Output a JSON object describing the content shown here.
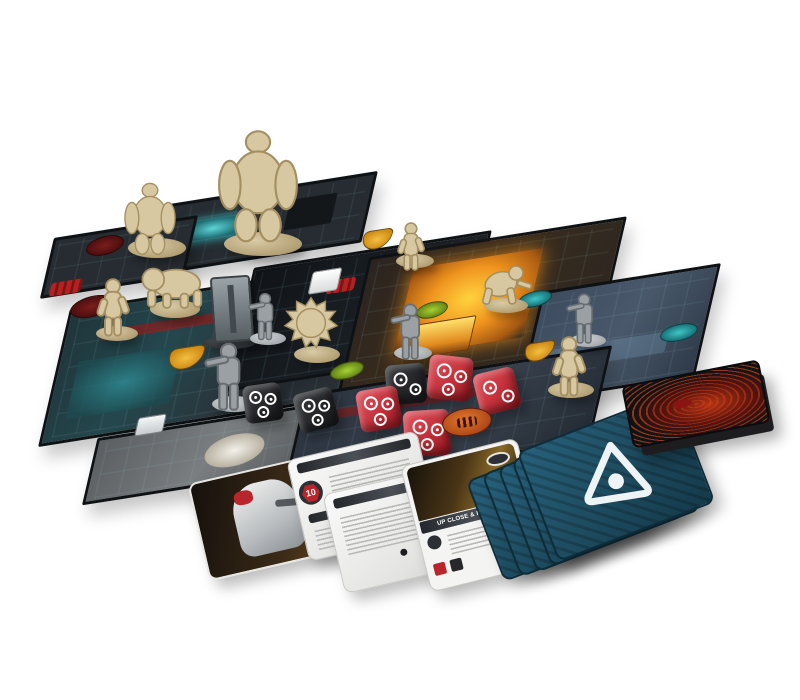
{
  "scene": {
    "description": "Sci-fi horror dungeon-crawler board game (DOOM-style) set up and photographed on a white background",
    "background": "#ffffff"
  },
  "board": {
    "tile_count": 8,
    "tile_colors": {
      "dark": "#262c31",
      "teal_glow": "#2f7d84",
      "lava_orange": "#f0941e",
      "blue_grey": "#49596b"
    },
    "tokens": [
      {
        "name": "portal-token",
        "color": "#5f1717",
        "count": 2
      },
      {
        "name": "rune-marker",
        "color": "#a32020",
        "count": 2
      },
      {
        "name": "shield-token",
        "color": "#e0a11e",
        "count": 3
      },
      {
        "name": "status-token-green",
        "color": "#7da821",
        "count": 2
      },
      {
        "name": "status-token-teal",
        "color": "#1d8f94",
        "count": 2
      },
      {
        "name": "terminal-token",
        "color": "#e8ecee",
        "count": 1
      },
      {
        "name": "objective-marker",
        "color": "#f2f2f0",
        "count": 1
      }
    ],
    "miniatures": {
      "demon_color": "#d8c8a2",
      "marine_color": "#9aa0a4",
      "demons": [
        "baron",
        "mancubus",
        "pinky",
        "cacodemon",
        "imp",
        "imp",
        "zombie",
        "zombie"
      ],
      "marine_count": 4,
      "door_count": 1
    }
  },
  "dice": {
    "black": {
      "count": 3,
      "color": "#26282b",
      "pip_style": "gear-ring",
      "pip_color": "#ffffff"
    },
    "red": {
      "count": 4,
      "color": "#c4313a",
      "pip_style": "ring",
      "pip_color": "#ffffff"
    },
    "threat_token_color": "#c2541d"
  },
  "cards": {
    "marine_card": {
      "type": "landscape hero card",
      "art": "armored marine with rifle"
    },
    "class_card": {
      "badge_value": "10"
    },
    "weapon_card": {
      "title": "UP CLOSE & PERSONAL"
    },
    "initiative_deck": {
      "count": 5,
      "back_color": "#1d4a5e",
      "emblem": "uac-triangle"
    },
    "event_deck": {
      "back_color": "#141414",
      "art": "red demonic sigil"
    }
  }
}
